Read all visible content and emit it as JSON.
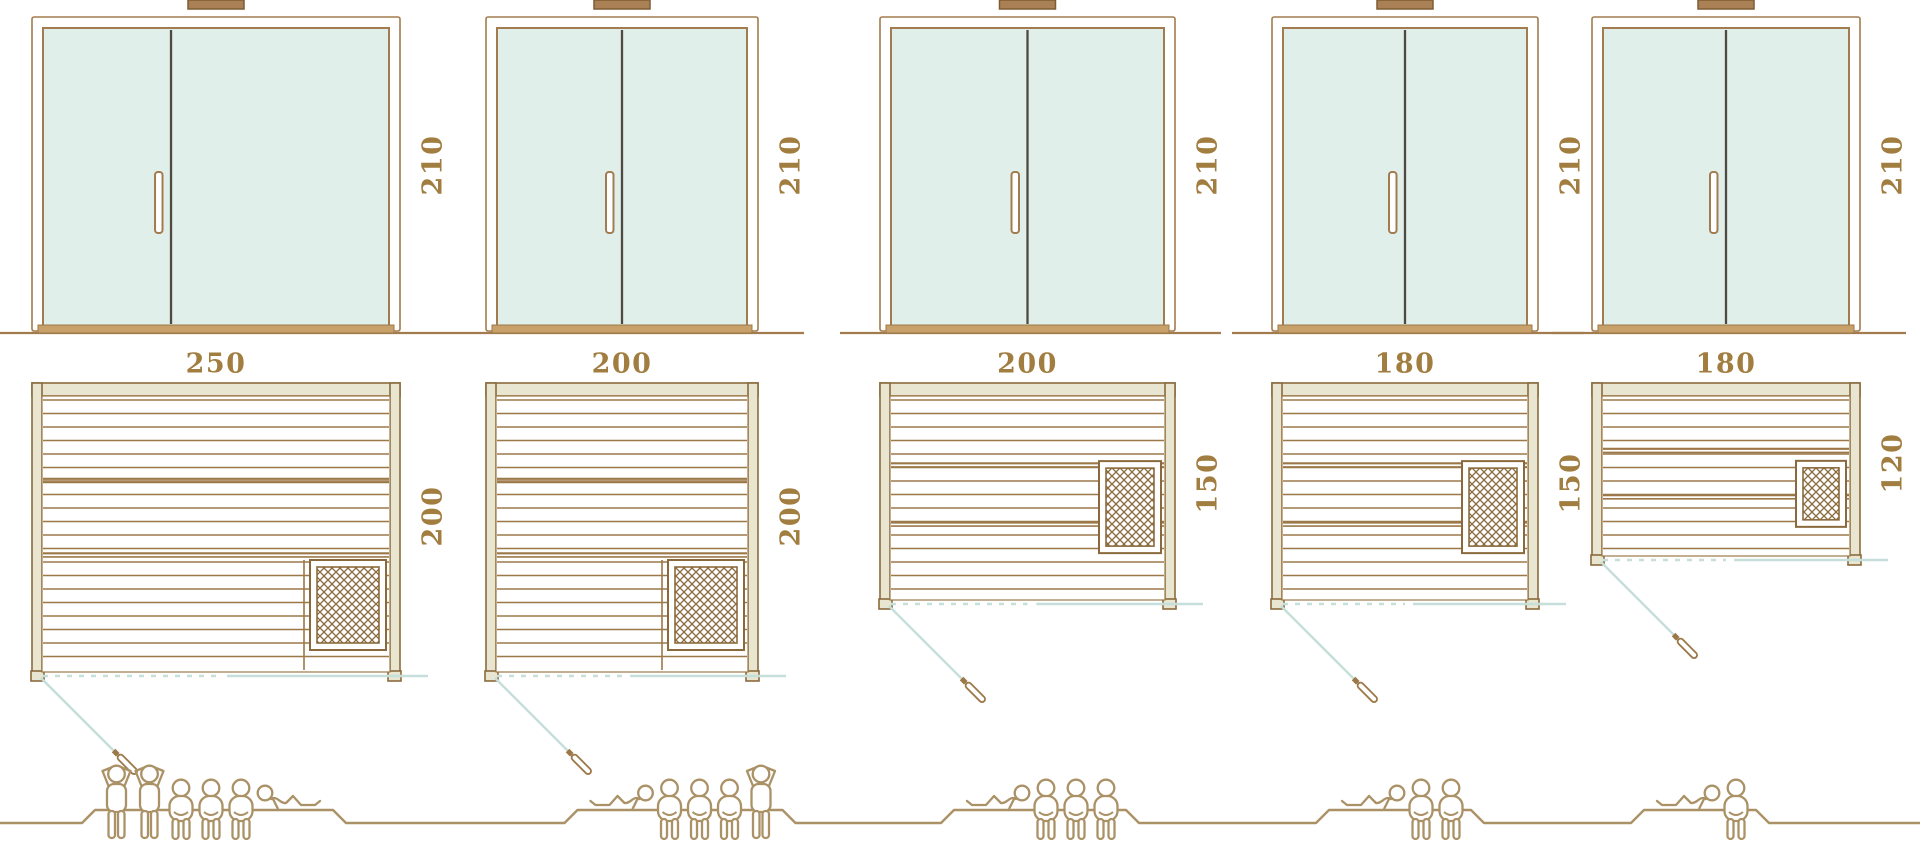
{
  "diagram": "sauna-size-comparison",
  "palette": {
    "wood": "#9c7848",
    "frame": "#a27c4e",
    "divider_dark": "#4f4a41",
    "glass": "#e1efeb",
    "wall_fill": "#e8e5d1",
    "wall_stroke": "#8a6a3c",
    "threshold_tan": "#c7a06a",
    "chimney_fill": "#aa8154",
    "chimney_stroke": "#7e5c33",
    "door_swing_blue": "#c6dfda",
    "label_brown": "#a17d40",
    "people_brown": "#ab9166"
  },
  "saunas": [
    {
      "width_cm": "250",
      "depth_cm": "200",
      "height_cm": "210",
      "capacity": 6,
      "figures": [
        "standing",
        "standing",
        "seated",
        "seated",
        "seated",
        "lying-right"
      ]
    },
    {
      "width_cm": "200",
      "depth_cm": "200",
      "height_cm": "210",
      "capacity": 5,
      "figures": [
        "lying-left",
        "seated",
        "seated",
        "seated",
        "standing"
      ]
    },
    {
      "width_cm": "200",
      "depth_cm": "150",
      "height_cm": "210",
      "capacity": 4,
      "figures": [
        "lying-left",
        "seated",
        "seated",
        "seated"
      ]
    },
    {
      "width_cm": "180",
      "depth_cm": "150",
      "height_cm": "210",
      "capacity": 3,
      "figures": [
        "lying-left",
        "seated",
        "seated"
      ]
    },
    {
      "width_cm": "180",
      "depth_cm": "120",
      "height_cm": "210",
      "capacity": 2,
      "figures": [
        "lying-left",
        "seated"
      ]
    }
  ]
}
